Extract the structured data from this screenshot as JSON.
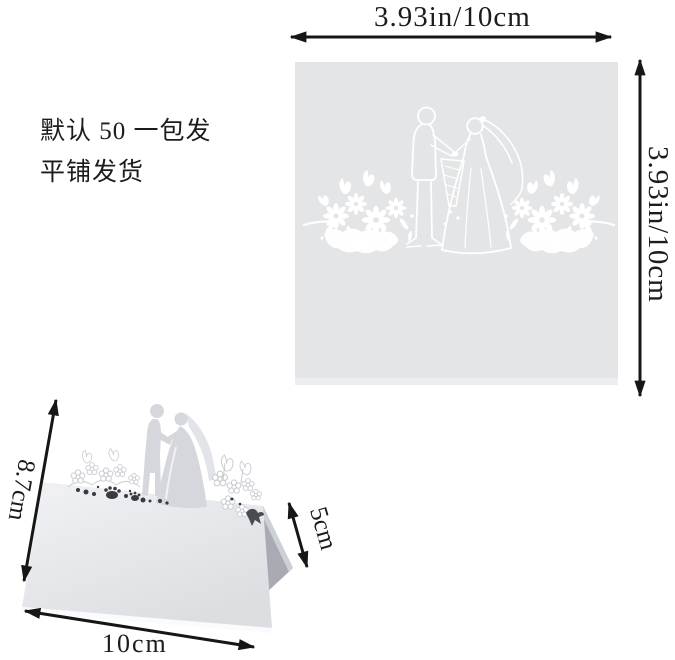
{
  "colors": {
    "page_bg": "#ffffff",
    "flat_card_gray": "#e4e5e7",
    "cut_white": "#ffffff",
    "face_light": "#f1f2f5",
    "face_dark": "#dcdee2",
    "back_panel": "#a8abb3",
    "back_panel_edge": "#cdd0d5",
    "silhouette_gray": "#d5d7dc",
    "veil_gray": "#e2e4e9",
    "outline_gray": "#c9ccd2",
    "cut_dark": "#3a3b40",
    "dimension_line": "#161616",
    "text_color": "#1c1c1c"
  },
  "dimensions": {
    "flat_width": "3.93in/10cm",
    "flat_height": "3.93in/10cm",
    "folded_depth": "8.7cm",
    "folded_back_height": "5cm",
    "folded_width": "10cm"
  },
  "notes": {
    "line1": "默认 50 一包发",
    "line2": "平铺发货"
  },
  "figures": {
    "flat_card": "flat-laser-cut-wedding-place-card",
    "folded_card": "folded-tent-style-place-card"
  }
}
